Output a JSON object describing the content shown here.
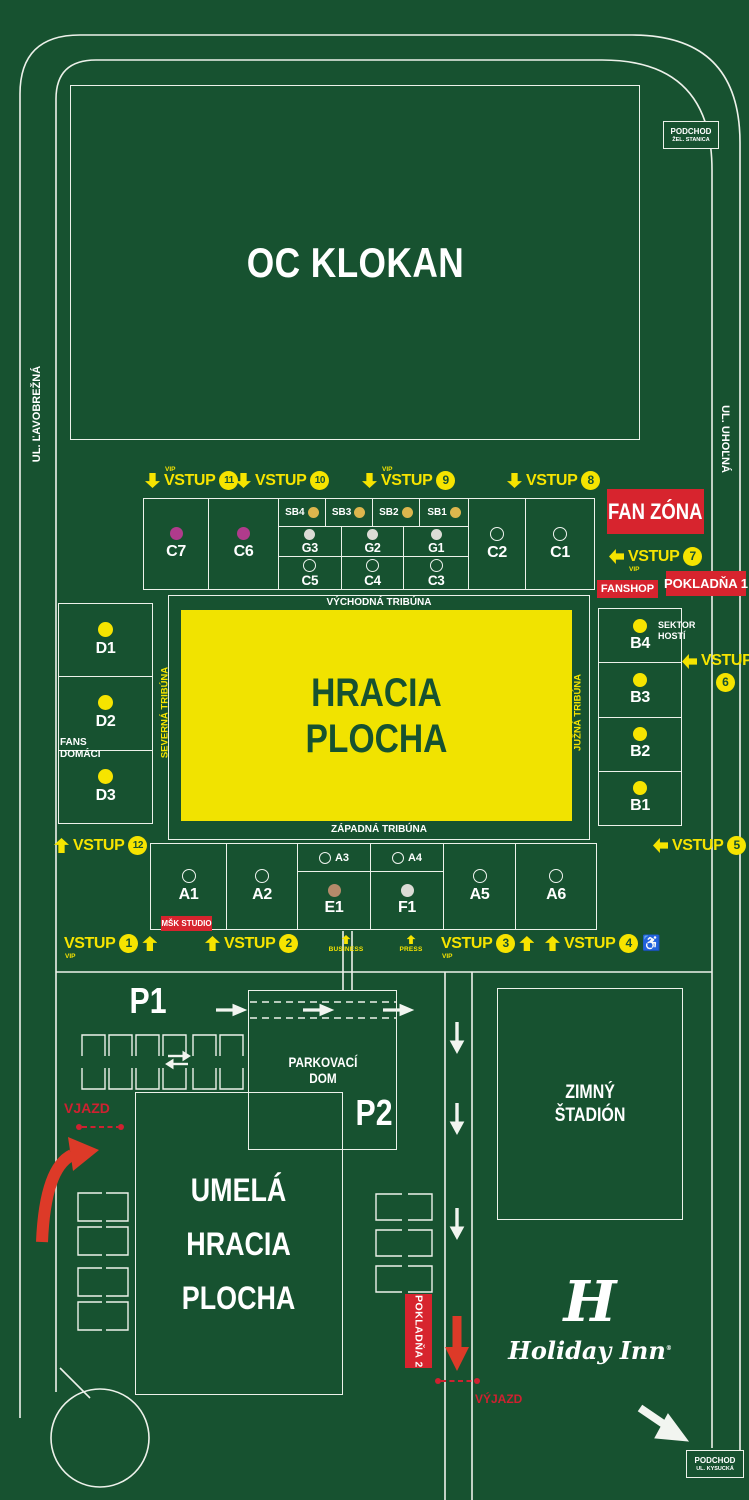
{
  "colors": {
    "background": "#175230",
    "road_white": "#edf1ea",
    "accent_yellow": "#f6e400",
    "pitch_yellow": "#f1e300",
    "pitch_text_green": "#175230",
    "sign_red": "#d7242e",
    "arrow_red": "#dd3a28",
    "sector_dot_yellow": "#f6e400",
    "sector_dot_magenta": "#b03b8c",
    "sector_dot_gold": "#ddb64d",
    "sector_dot_light": "#dcdcd6",
    "sector_dot_tan": "#b58a6a"
  },
  "streets": {
    "left": "UL. ĽAVOBREŽNÁ",
    "right": "UL. UHOĽNÁ"
  },
  "signs": {
    "podchod_station": {
      "title": "PODCHOD",
      "subtitle": "ŽEL. STANICA"
    },
    "podchod_kysucka": {
      "title": "PODCHOD",
      "subtitle": "UL. KYSUCKÁ"
    },
    "oc_klokan": "OC KLOKAN",
    "fan_zona": "FAN ZÓNA",
    "fanshop": "FANSHOP",
    "pokladna1": "POKLADŇA 1",
    "pokladna2": "POKLADŇA 2",
    "msk_studio": "MŠK STUDIO",
    "vjazd": "VJAZD",
    "vyjazd": "VÝJAZD",
    "p1": "P1",
    "p2": "P2",
    "parkovaci_dom": {
      "line1": "PARKOVACÍ",
      "line2": "DOM"
    },
    "zimny_stadion": {
      "line1": "ZIMNÝ",
      "line2": "ŠTADIÓN"
    },
    "umela": {
      "line1": "UMELÁ",
      "line2": "HRACIA",
      "line3": "PLOCHA"
    },
    "fans_domaci": {
      "line1": "FANS",
      "line2": "DOMÁCI"
    },
    "sektor_hosti": {
      "line1": "SEKTOR",
      "line2": "HOSTÍ"
    },
    "holiday_inn": {
      "monogram": "H",
      "name": "Holiday Inn",
      "reg": "®"
    }
  },
  "pitch": {
    "line1": "HRACIA",
    "line2": "PLOCHA"
  },
  "tribunes": {
    "east": "VÝCHODNÁ TRIBÚNA",
    "west": "ZÁPADNÁ TRIBÚNA",
    "north": "SEVERNÁ TRIBÚNA",
    "south": "JUŽNÁ TRIBÚNA"
  },
  "entrances": {
    "e1": {
      "label": "VSTUP",
      "num": "1",
      "vip": "VIP"
    },
    "e2": {
      "label": "VSTUP",
      "num": "2"
    },
    "e3": {
      "label": "VSTUP",
      "num": "3",
      "vip": "VIP"
    },
    "e4": {
      "label": "VSTUP",
      "num": "4"
    },
    "e5": {
      "label": "VSTUP",
      "num": "5"
    },
    "e6": {
      "label": "VSTUP",
      "num": "6"
    },
    "e7": {
      "label": "VSTUP",
      "num": "7",
      "vip": "VIP"
    },
    "e8": {
      "label": "VSTUP",
      "num": "8"
    },
    "e9": {
      "label": "VSTUP",
      "num": "9",
      "vip": "VIP"
    },
    "e10": {
      "label": "VSTUP",
      "num": "10"
    },
    "e11": {
      "label": "VSTUP",
      "num": "11",
      "vip": "VIP"
    },
    "e12": {
      "label": "VSTUP",
      "num": "12"
    },
    "business": "BUSINESS",
    "press": "PRESS"
  },
  "sectors": {
    "east": {
      "c7": "C7",
      "c6": "C6",
      "sb4": "SB4",
      "sb3": "SB3",
      "sb2": "SB2",
      "sb1": "SB1",
      "g3": "G3",
      "g2": "G2",
      "g1": "G1",
      "c5": "C5",
      "c4": "C4",
      "c3": "C3",
      "c2": "C2",
      "c1": "C1"
    },
    "north": {
      "d1": "D1",
      "d2": "D2",
      "d3": "D3"
    },
    "south": {
      "b4": "B4",
      "b3": "B3",
      "b2": "B2",
      "b1": "B1"
    },
    "west": {
      "a1": "A1",
      "a2": "A2",
      "a3": "A3",
      "a4": "A4",
      "e1": "E1",
      "f1": "F1",
      "a5": "A5",
      "a6": "A6"
    }
  }
}
